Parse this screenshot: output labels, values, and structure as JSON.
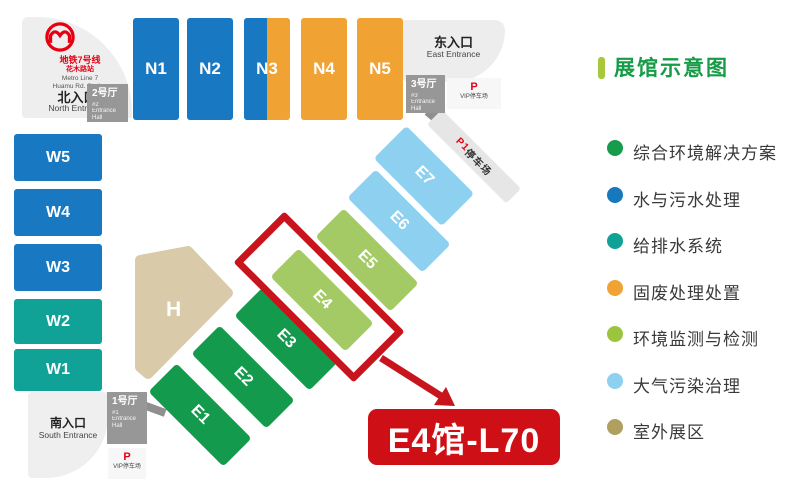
{
  "colors": {
    "hall_blue": "#1879c2",
    "hall_teal": "#10a296",
    "hall_orange": "#f0a232",
    "hall_green": "#149a4d",
    "hall_light_green": "#a3ca64",
    "hall_light_blue": "#8dd0f0",
    "hall_tan": "#d9cbaa",
    "highlight_red": "#c8141c",
    "label_red": "#ce1016",
    "metro_red": "#e60012",
    "legend_title_green": "#169b46",
    "legend_bar_green": "#a6c83a"
  },
  "map": {
    "metro": {
      "line_zh": "地铁7号线",
      "station_zh": "花木路站",
      "line_en": "Metro Line 7",
      "station_en": "Huamu Rd. Station"
    },
    "north_entrance": {
      "zh": "北入口",
      "en": "North Entrance"
    },
    "east_entrance": {
      "zh": "东入口",
      "en": "East Entrance"
    },
    "south_entrance": {
      "zh": "南入口",
      "en": "South Entrance"
    },
    "hall2": {
      "zh": "2号厅",
      "no": "#2",
      "en": "Entrance Hall"
    },
    "hall3": {
      "zh": "3号厅",
      "no": "#3",
      "en": "Entrance Hall"
    },
    "hall1": {
      "zh": "1号厅",
      "no": "#1",
      "en": "Entrance Hall"
    },
    "vip_parking_top": {
      "p": "P",
      "label": "VIP停车场"
    },
    "vip_parking_bottom": {
      "p": "P",
      "label": "VIP停车场"
    },
    "p1_parking": {
      "p": "P1",
      "label": "停车场"
    },
    "halls_north": [
      {
        "label": "N1",
        "color": "#1879c2"
      },
      {
        "label": "N2",
        "color": "#1879c2"
      },
      {
        "label": "N3",
        "color": "#1879c2",
        "color2": "#f0a232"
      },
      {
        "label": "N4",
        "color": "#f0a232"
      },
      {
        "label": "N5",
        "color": "#f0a232"
      }
    ],
    "halls_west": [
      {
        "label": "W5",
        "color": "#1879c2"
      },
      {
        "label": "W4",
        "color": "#1879c2"
      },
      {
        "label": "W3",
        "color": "#1879c2"
      },
      {
        "label": "W2",
        "color": "#10a296"
      },
      {
        "label": "W1",
        "color": "#10a296"
      }
    ],
    "halls_east": [
      {
        "label": "E1",
        "color": "#149a4d"
      },
      {
        "label": "E2",
        "color": "#149a4d"
      },
      {
        "label": "E3",
        "color": "#149a4d"
      },
      {
        "label": "E4",
        "color": "#a3ca64"
      },
      {
        "label": "E5",
        "color": "#a3ca64"
      },
      {
        "label": "E6",
        "color": "#8dd0f0"
      },
      {
        "label": "E7",
        "color": "#8dd0f0"
      }
    ],
    "hall_h": {
      "label": "H",
      "color": "#d9cbaa"
    },
    "highlight_label": "E4馆-L70"
  },
  "legend": {
    "title": "展馆示意图",
    "items": [
      {
        "label": "综合环境解决方案",
        "color": "#169c4b"
      },
      {
        "label": "水与污水处理",
        "color": "#1778be"
      },
      {
        "label": "给排水系统",
        "color": "#10a296"
      },
      {
        "label": "固废处理处置",
        "color": "#f0a232"
      },
      {
        "label": "环境监测与检测",
        "color": "#9cc53e"
      },
      {
        "label": "大气污染治理",
        "color": "#8dd0f0"
      },
      {
        "label": "室外展区",
        "color": "#b0a060"
      }
    ]
  }
}
